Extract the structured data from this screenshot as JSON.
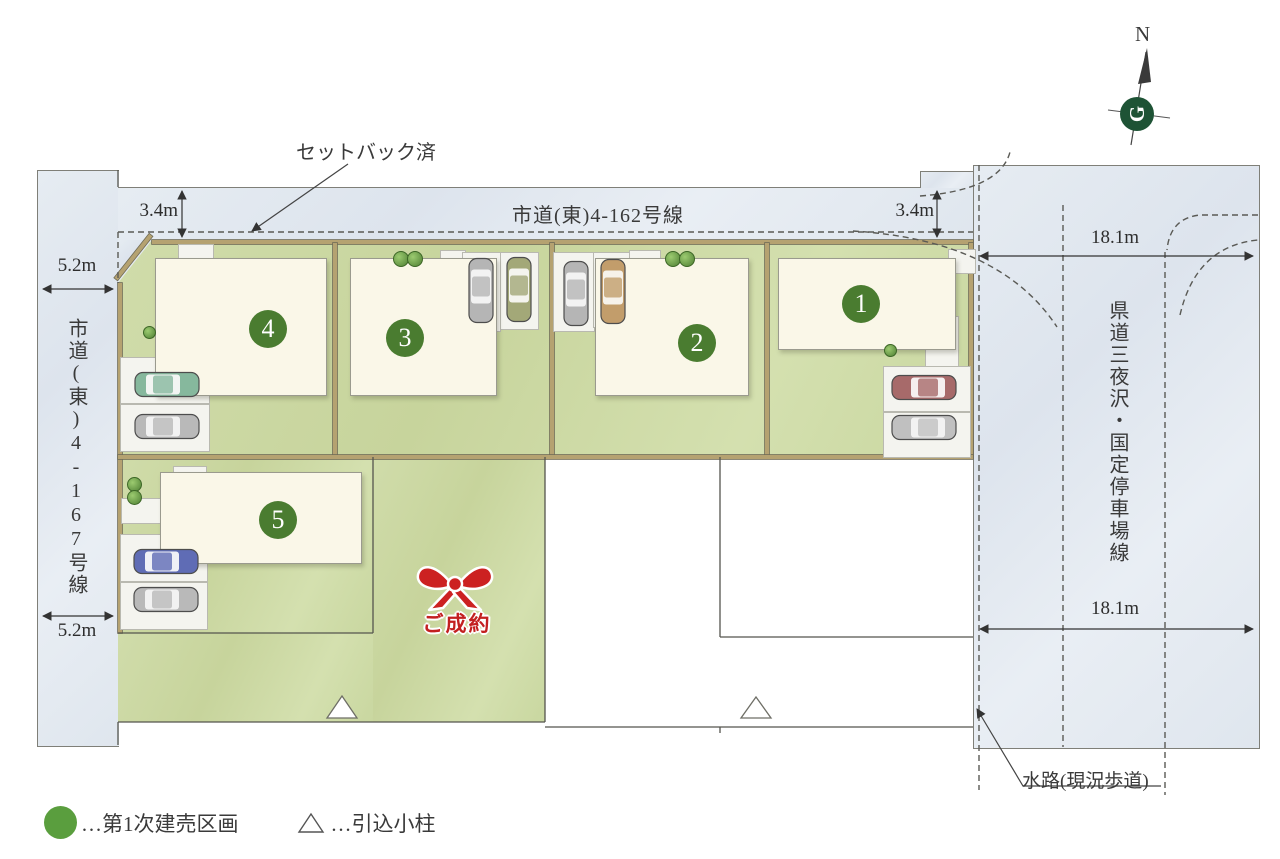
{
  "roads": {
    "top_label": "市道(東)4-162号線",
    "left_label": "市道(東)4-167号線",
    "right_label": "県道三夜沢・国定停車場線"
  },
  "dimensions": {
    "setback_left": "3.4m",
    "setback_right": "3.4m",
    "left_road_width_top": "5.2m",
    "left_road_width_bottom": "5.2m",
    "right_road_width_top": "18.1m",
    "right_road_width_bottom": "18.1m"
  },
  "annotations": {
    "setback_label": "セットバック済",
    "waterway_label": "水路(現況歩道)",
    "sold_label": "ご成約"
  },
  "lots": [
    {
      "number": "1"
    },
    {
      "number": "2"
    },
    {
      "number": "3"
    },
    {
      "number": "4"
    },
    {
      "number": "5"
    }
  ],
  "legend": {
    "lot_marker_label": "…第1次建売区画",
    "pole_marker_label": "…引込小柱"
  },
  "compass": {
    "north_label": "N",
    "logo_letter": "G"
  },
  "colors": {
    "lot_number_green": "#4a7c30",
    "legend_green": "#5a9e3e",
    "sold_red": "#c32020",
    "road_blue": "#e2e8f0",
    "lot_green": "#ccd8a0",
    "house_ivory": "#faf7e8",
    "boundary_tan": "#b5a271"
  }
}
